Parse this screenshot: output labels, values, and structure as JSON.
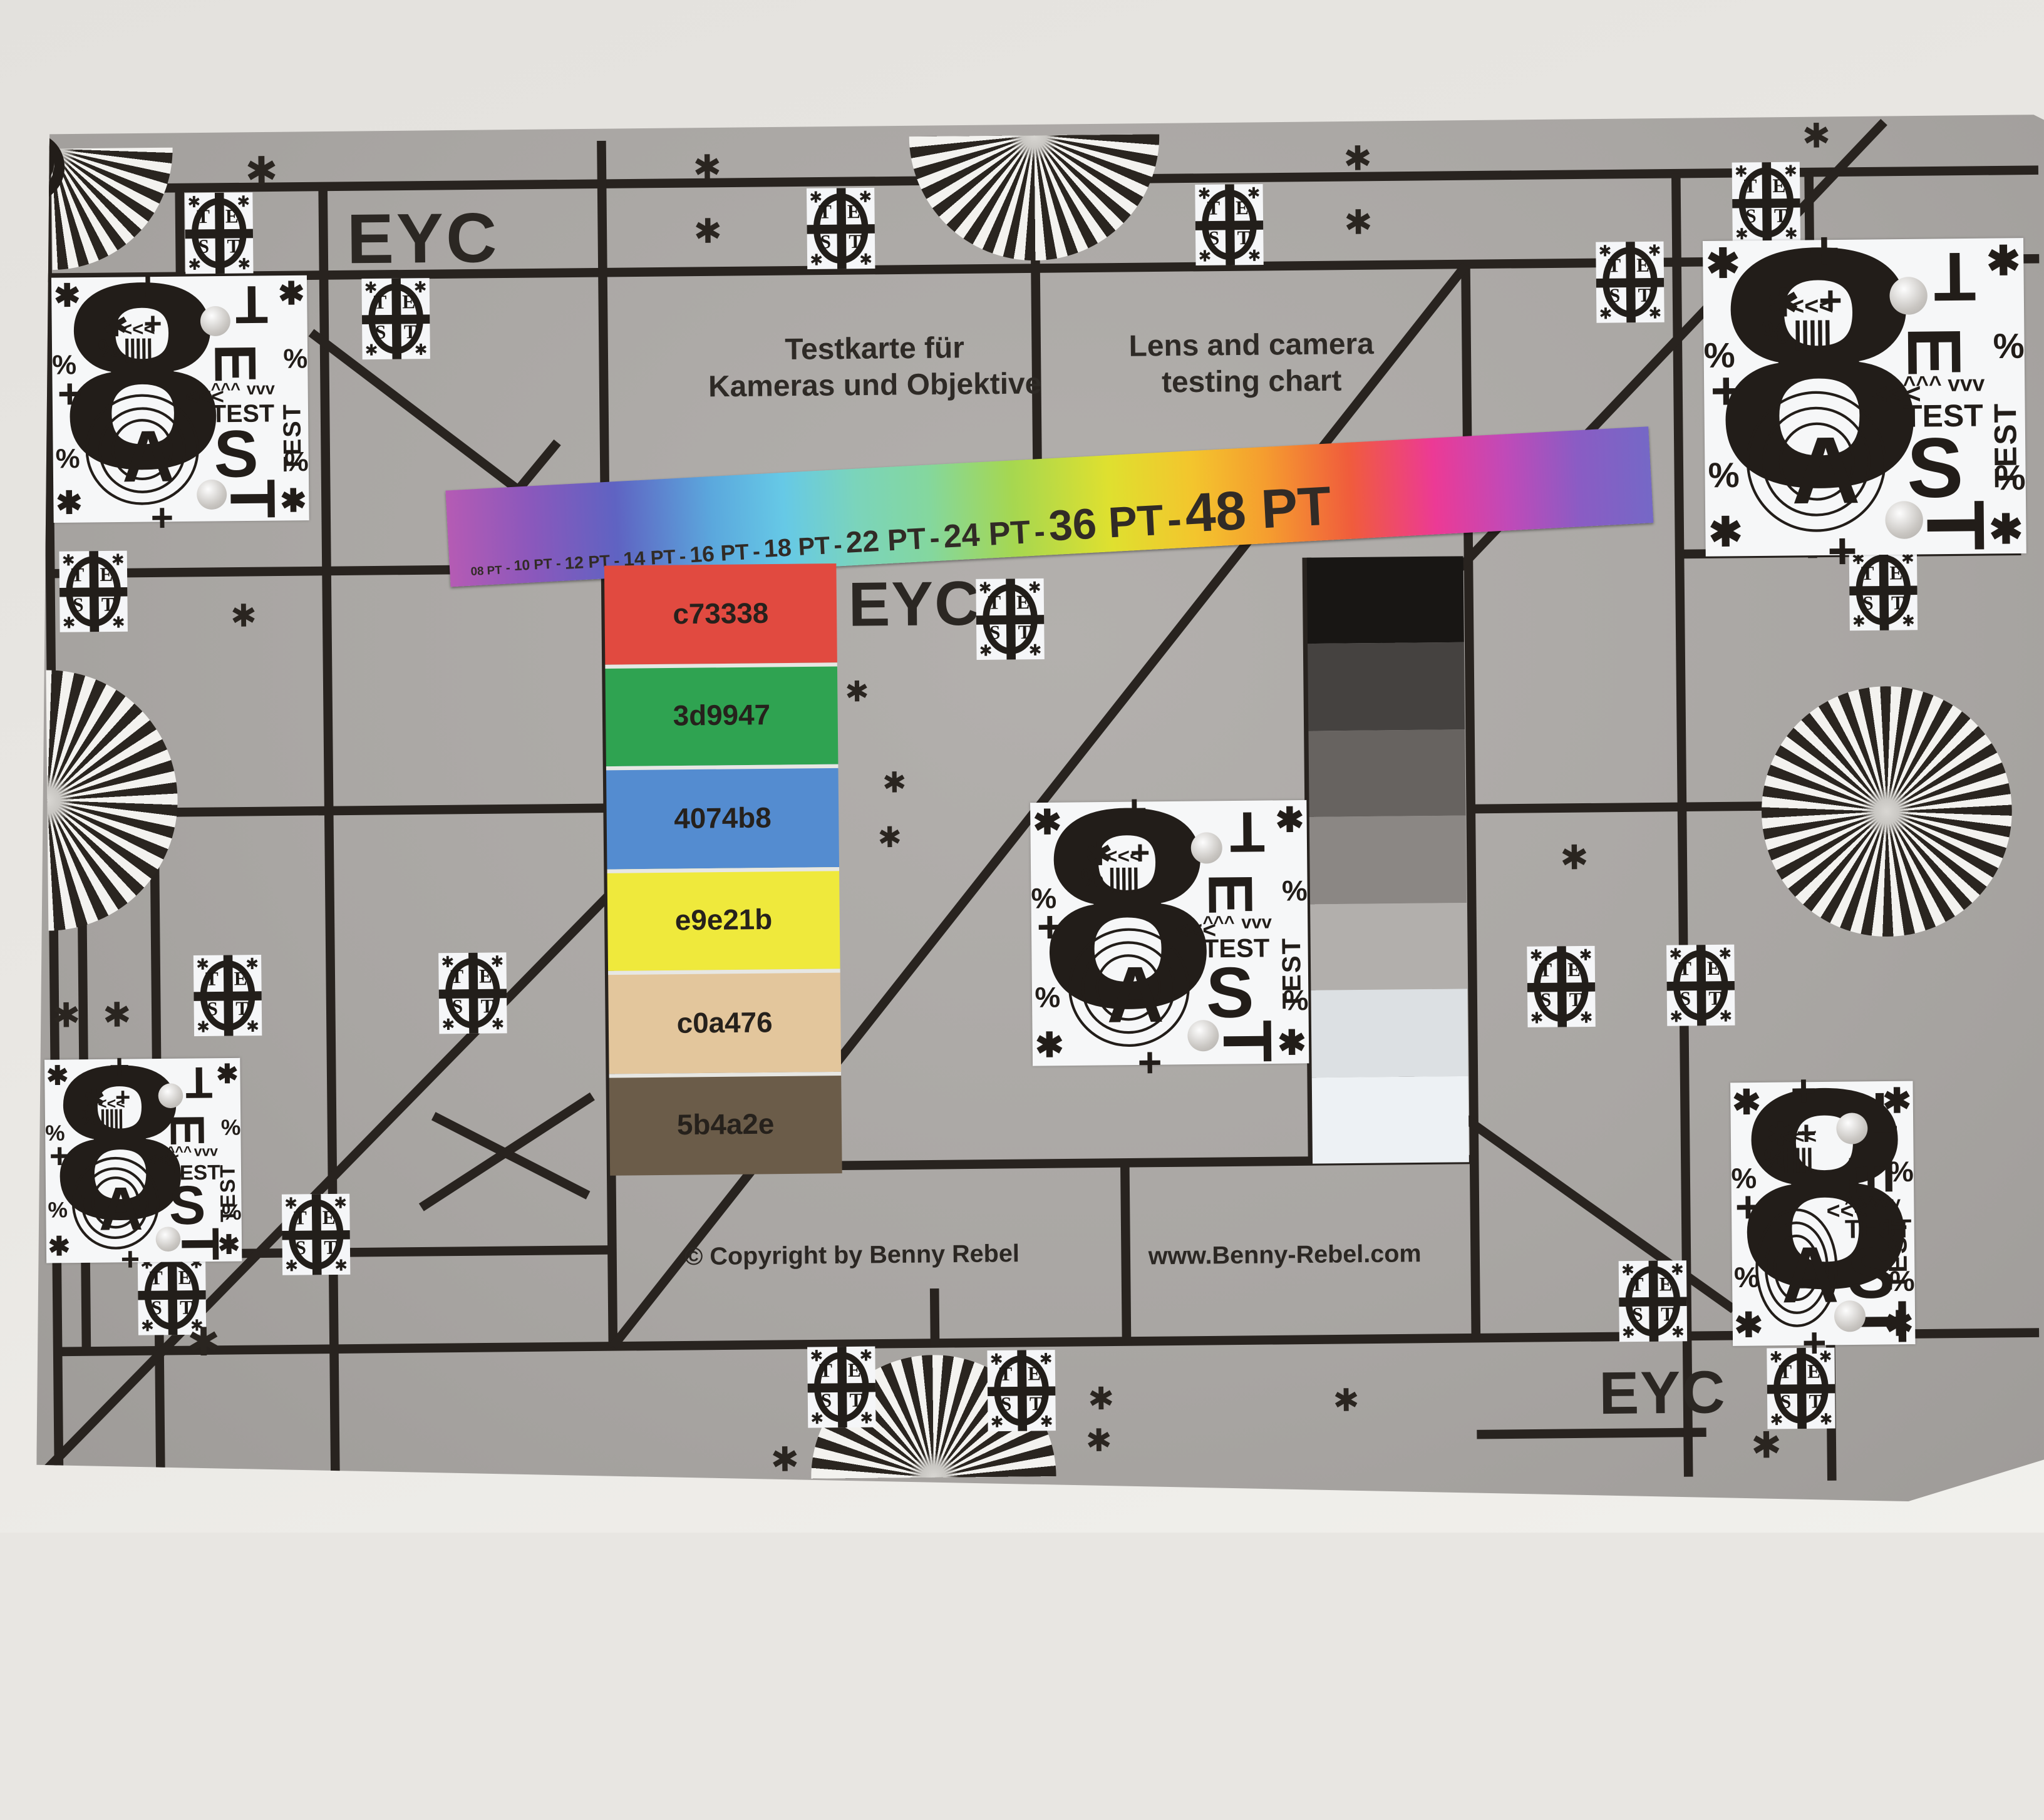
{
  "chart": {
    "eyc_top_left": "EYC",
    "eyc_center": "EYC",
    "eyc_bottom_right": "EYC",
    "title_de_line1": "Testkarte für",
    "title_de_line2": "Kameras und Objektive",
    "title_en_line1": "Lens and camera",
    "title_en_line2": "testing chart",
    "copyright": "© Copyright by Benny Rebel",
    "website": "www.Benny-Rebel.com",
    "pt_scale": {
      "labels": [
        "08 PT",
        "10 PT",
        "12 PT",
        "14 PT",
        "16 PT",
        "18 PT",
        "22 PT",
        "24 PT",
        "36 PT",
        "48 PT"
      ],
      "separator": "-"
    },
    "color_swatches": [
      {
        "label": "c73338",
        "display": "#e14a40"
      },
      {
        "label": "3d9947",
        "display": "#2fa351"
      },
      {
        "label": "4074b8",
        "display": "#548cd0"
      },
      {
        "label": "e9e21b",
        "display": "#efe93c"
      },
      {
        "label": "c0a476",
        "display": "#e3c69c"
      },
      {
        "label": "5b4a2e",
        "display": "#6b5c49"
      }
    ],
    "grayscale_steps": [
      "#181614",
      "#454240",
      "#676360",
      "#8b8784",
      "#b2afac",
      "#dce0e3",
      "#edf1f4"
    ],
    "test_circle_letters": [
      "T",
      "E",
      "S",
      "T"
    ],
    "block": {
      "digit": "8",
      "letter_a": "A",
      "test_word": "TEST",
      "column_letters": [
        "T",
        "E",
        "S",
        "T"
      ],
      "percent": "%",
      "asterisk": "✱",
      "plus": "+",
      "chevrons_left": "<<<",
      "chevrons_up": "^^^",
      "chevrons_down": "vvv"
    },
    "colors": {
      "chart_background": "#a9a6a3",
      "grid_line": "#28231f",
      "wall": "#e9e7e3",
      "tile_background": "#f5f6f8",
      "block_background": "#f6f7f8"
    }
  }
}
